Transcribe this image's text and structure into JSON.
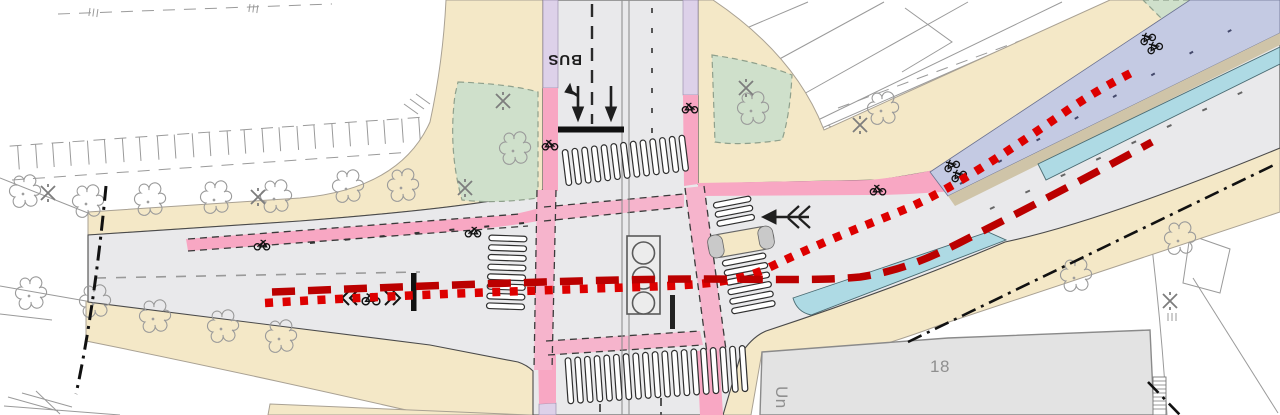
{
  "map": {
    "labels": {
      "bus_lane": "BUS",
      "building_number": "18",
      "building_name_partial": "Un"
    },
    "colors": {
      "background": "#ffffff",
      "road": "#e9e9eb",
      "sidewalk": "#f4e8c7",
      "bike_lane_pink": "#f8a7c3",
      "bike_crossing_pink": "#f6b4cc",
      "parking_lavender": "#ddd1e9",
      "green_area": "#cfe0cb",
      "cycleway_blue": "#c4cae3",
      "median_tan": "#cfc4a8",
      "platform_cyan": "#aedae4",
      "building_gray": "#e3e3e3",
      "survey_gray": "#9a9a9a",
      "marking_dark": "#1f1f1f",
      "route_dashed_red": "#bb0000",
      "route_dotted_red": "#dd0000"
    },
    "routes": [
      {
        "id": "route-dotted",
        "style": "dotted"
      },
      {
        "id": "route-dashed",
        "style": "dashed"
      }
    ]
  }
}
